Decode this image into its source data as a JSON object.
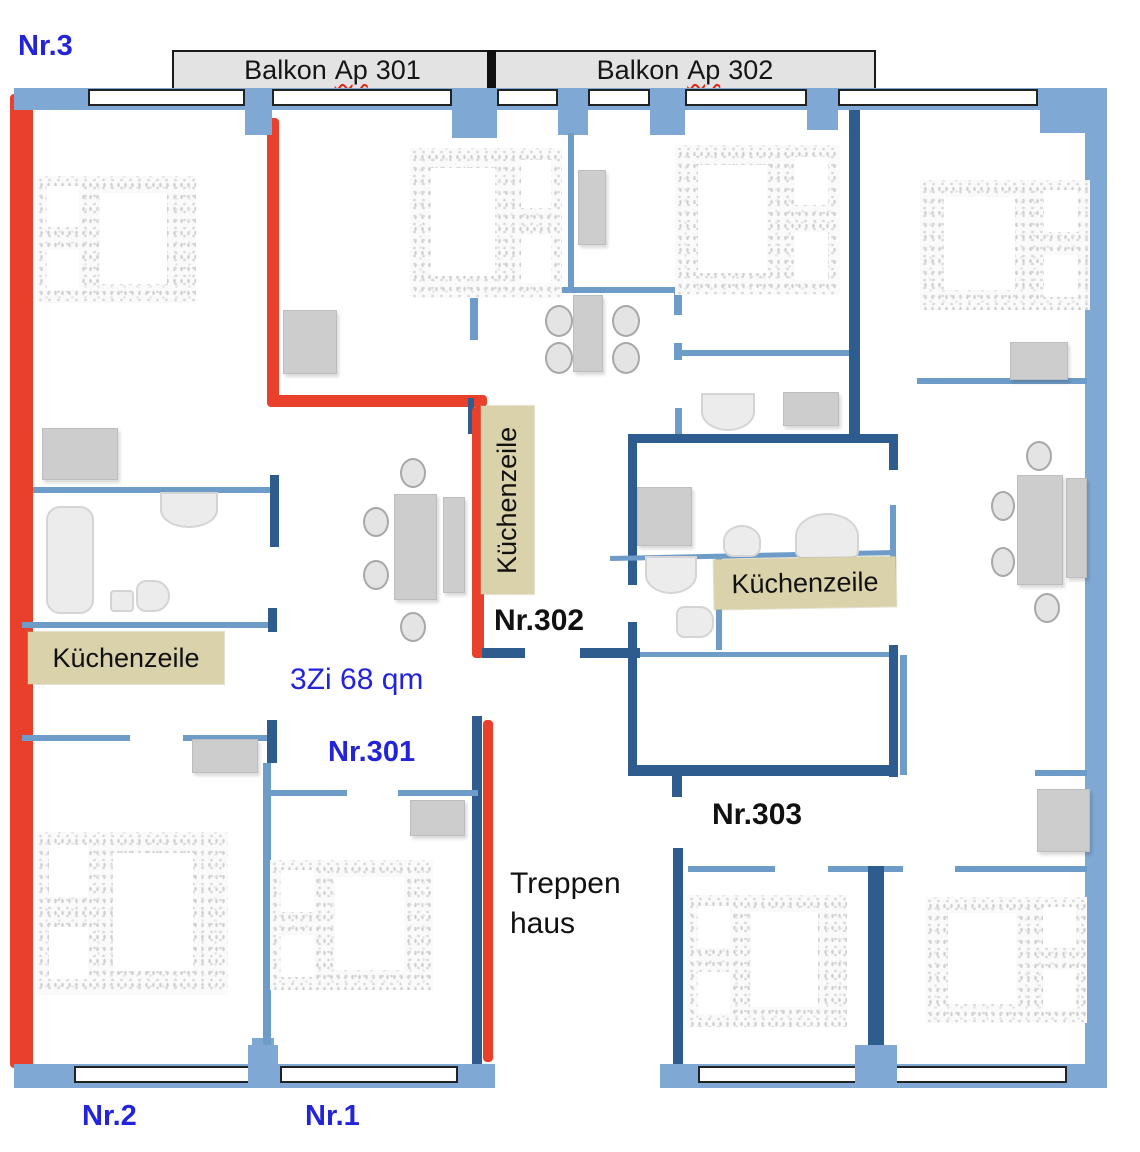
{
  "labels": {
    "nr3": "Nr.3",
    "nr301": "Nr.301",
    "nr302": "Nr.302",
    "nr303": "Nr.303",
    "nr1": "Nr.1",
    "nr2": "Nr.2",
    "area": "3Zi 68 qm",
    "kitchen": "Küchenzeile",
    "stairs_line1": "Treppen",
    "stairs_line2": "haus",
    "balcony_301": {
      "prefix": "Balkon",
      "word": "Ap",
      "number": "301"
    },
    "balcony_302": {
      "prefix": "Balkon",
      "word": "Ap",
      "number": "302"
    }
  },
  "colors": {
    "wall_blue": "#7FA8D4",
    "wall_blue_thin": "#6E9CC9",
    "wall_navy": "#2E5C8E",
    "wall_red": "#E8402B",
    "label_bg": "#D9D2AB",
    "text_blue": "#2323D9",
    "balcony_bg": "#E3E3E3"
  }
}
